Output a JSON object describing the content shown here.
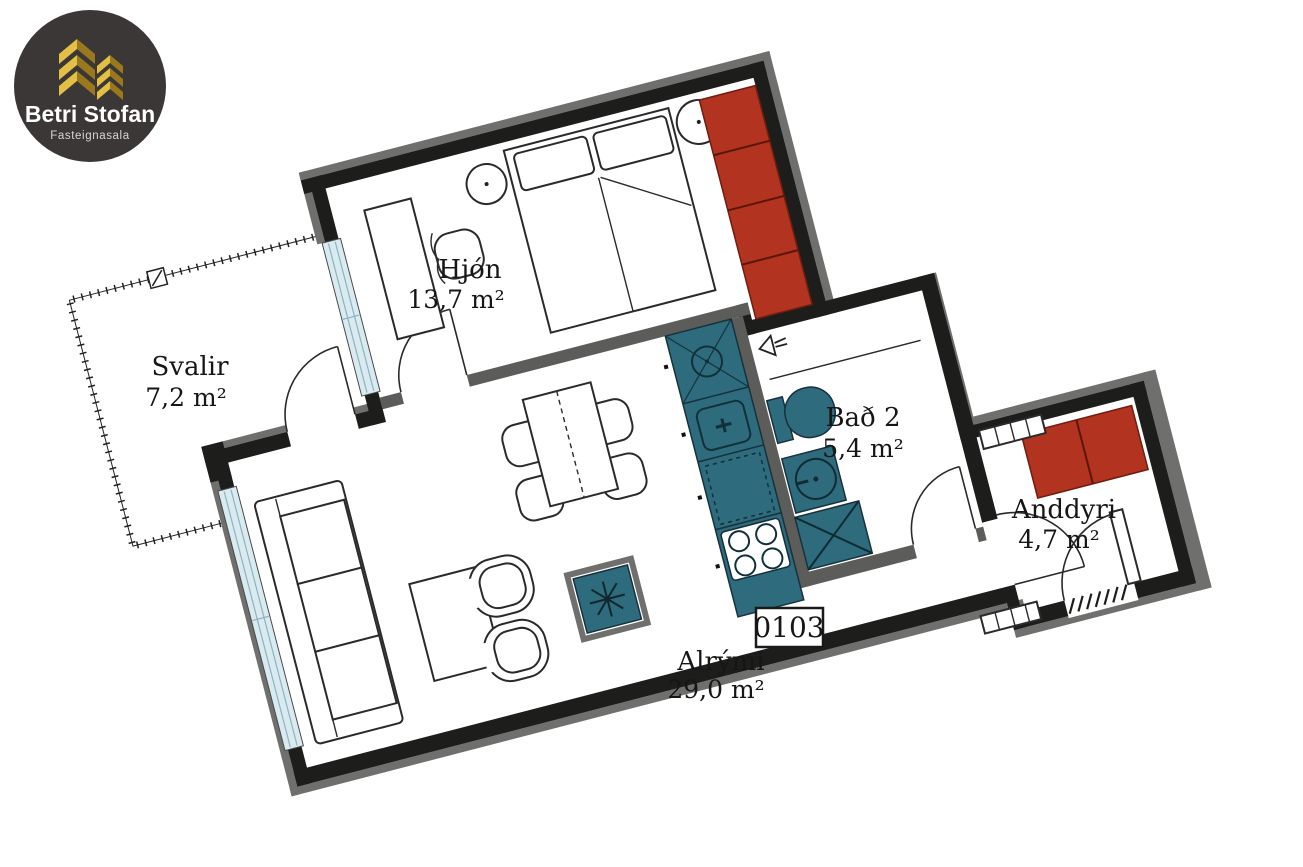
{
  "logo": {
    "title": "Betri Stofan",
    "subtitle": "Fasteignasala"
  },
  "unit": {
    "number": "0103"
  },
  "rooms": [
    {
      "key": "hjon",
      "name": "Hjón",
      "area": "13,7 m²"
    },
    {
      "key": "svalir",
      "name": "Svalir",
      "area": "7,2 m²"
    },
    {
      "key": "bad2",
      "name": "Bað 2",
      "area": "5,4 m²"
    },
    {
      "key": "anddyri",
      "name": "Anddyri",
      "area": "4,7 m²"
    },
    {
      "key": "alrymi",
      "name": "Alrými",
      "area": "29,0 m²"
    }
  ],
  "plan": {
    "type": "floor-plan",
    "rotation_deg": -14.5
  },
  "colors": {
    "exterior_wall": "#1d1d1b",
    "interior_wall": "#5c5c5a",
    "wall_band_gray": "#6f6f6d",
    "kitchen_bath_fixtures": "#2e6b7c",
    "wardrobe_red": "#b23320",
    "window_glass": "#d9eaf0",
    "background": "#ffffff",
    "logo_background": "#3a3736",
    "logo_gold": "#c9a22e"
  }
}
